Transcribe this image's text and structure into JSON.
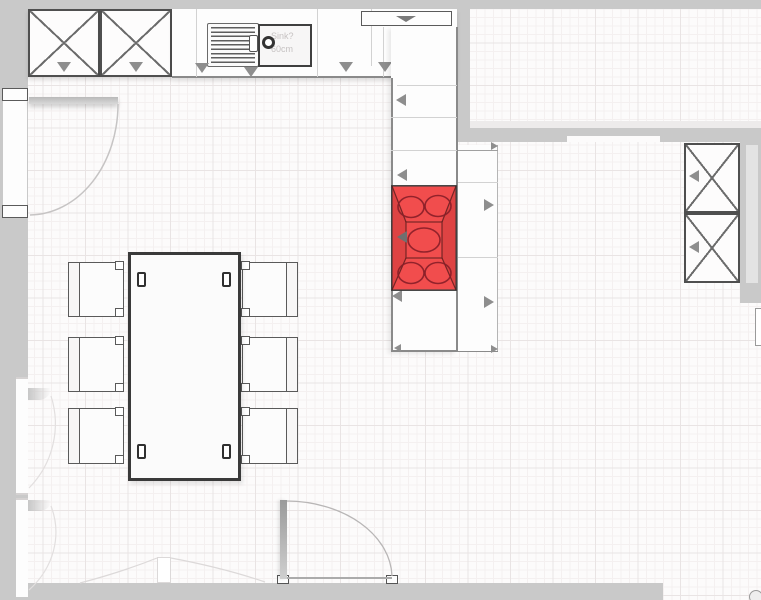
{
  "scene": {
    "type": "floor-plan",
    "view": "2d-top-down",
    "room": "kitchen-dining"
  },
  "sink": {
    "label_line1": "Sink?",
    "label_line2": "60cm"
  },
  "selection": {
    "item": "cooktop",
    "highlight_color": "#f03a3a",
    "burner_count": 5
  },
  "colors": {
    "wall": "#c9c9c9",
    "wall_window_inset": "#e3e3e3",
    "cabinet_border": "#4f4f4f",
    "indicator_gray": "#8e8e8e",
    "grid_minor": "#f4f0f0",
    "grid_major": "#e9e4e4",
    "background": "#fcfbfb"
  },
  "inventory": {
    "tall_cabinets_top_left": 2,
    "tall_cabinets_right": 2,
    "sink_run": "counter with drainer, sink bowl and faucet",
    "cooktop": "5-burner hob (selected, red)",
    "dining_table": 1,
    "dining_chairs": 6,
    "doors": 4
  }
}
